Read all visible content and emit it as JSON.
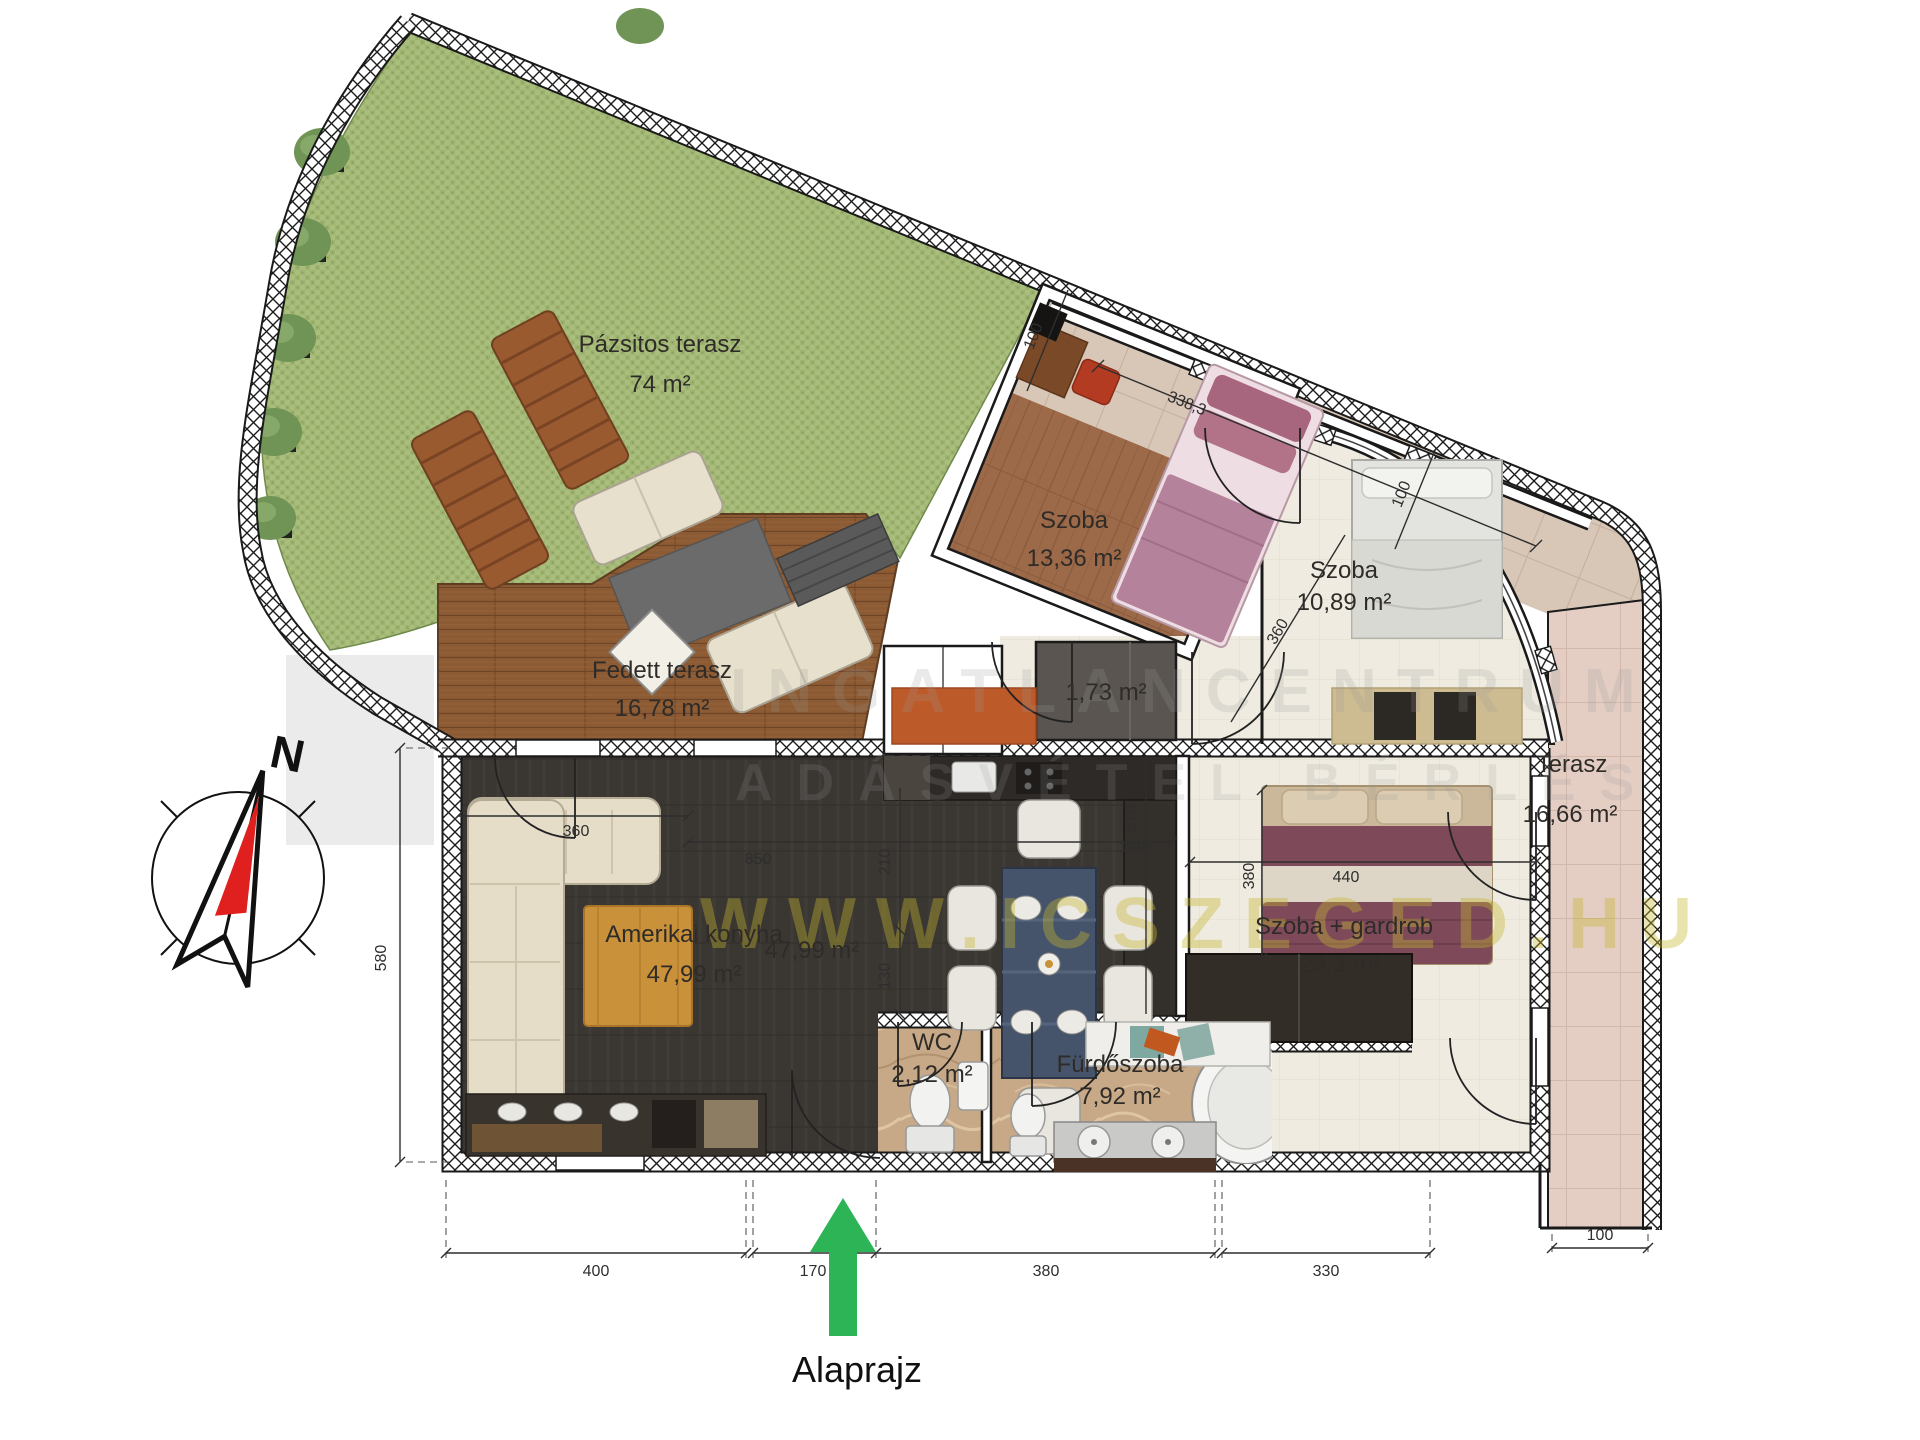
{
  "page": {
    "caption": "Alaprajz"
  },
  "compass": {
    "north": "N"
  },
  "rooms": {
    "grass": {
      "name": "Pázsitos terasz",
      "area": "74 m²"
    },
    "covered_terrace": {
      "name": "Fedett terasz",
      "area": "16,78 m²"
    },
    "bedroom1": {
      "name": "Szoba",
      "area": "13,36 m²"
    },
    "bedroom2": {
      "name": "Szoba",
      "area": "10,89 m²"
    },
    "closet": {
      "area": "1,73 m²"
    },
    "kitchen": {
      "name": "Amerikai konyha",
      "area": "47,99 m²",
      "area2": "47,99 m²"
    },
    "bedroom3": {
      "name": "Szoba + gardrob",
      "area": "23,3 m²"
    },
    "wc": {
      "name": "WC",
      "area": "2,12 m²"
    },
    "bathroom": {
      "name": "Fürdőszoba",
      "area": "7,92 m²"
    },
    "terrace": {
      "name": "Terasz",
      "area": "16,66 m²"
    }
  },
  "dimensions": {
    "bottom_400": "400",
    "bottom_170": "170",
    "bottom_380": "380",
    "bottom_330": "330",
    "bottom_100": "100",
    "left_580": "580",
    "diag_338": "338,3",
    "diag_100a": "100",
    "diag_100b": "100",
    "int_360": "360",
    "int_850": "850",
    "int_210": "210",
    "int_130a": "130",
    "int_510": "510",
    "int_130b": "130",
    "int_380": "380",
    "int_440": "440",
    "int_360b": "360"
  },
  "watermark": {
    "line1": "INGATLANCENTRUM",
    "line2": "ADÁSVÉTEL BÉRLÉS",
    "url": "WWW.ICSZEGED.HU"
  },
  "colors": {
    "grass": "#a9be7d",
    "deck": "#8c5a33",
    "dark_floor": "#3a3632",
    "cream_floor": "#efebe0",
    "marble": "#c8a987",
    "tile_beige": "#d8c6b6",
    "tile_pink": "#e4cec4",
    "arrow_green": "#2db457",
    "compass_red": "#e01f1f"
  }
}
